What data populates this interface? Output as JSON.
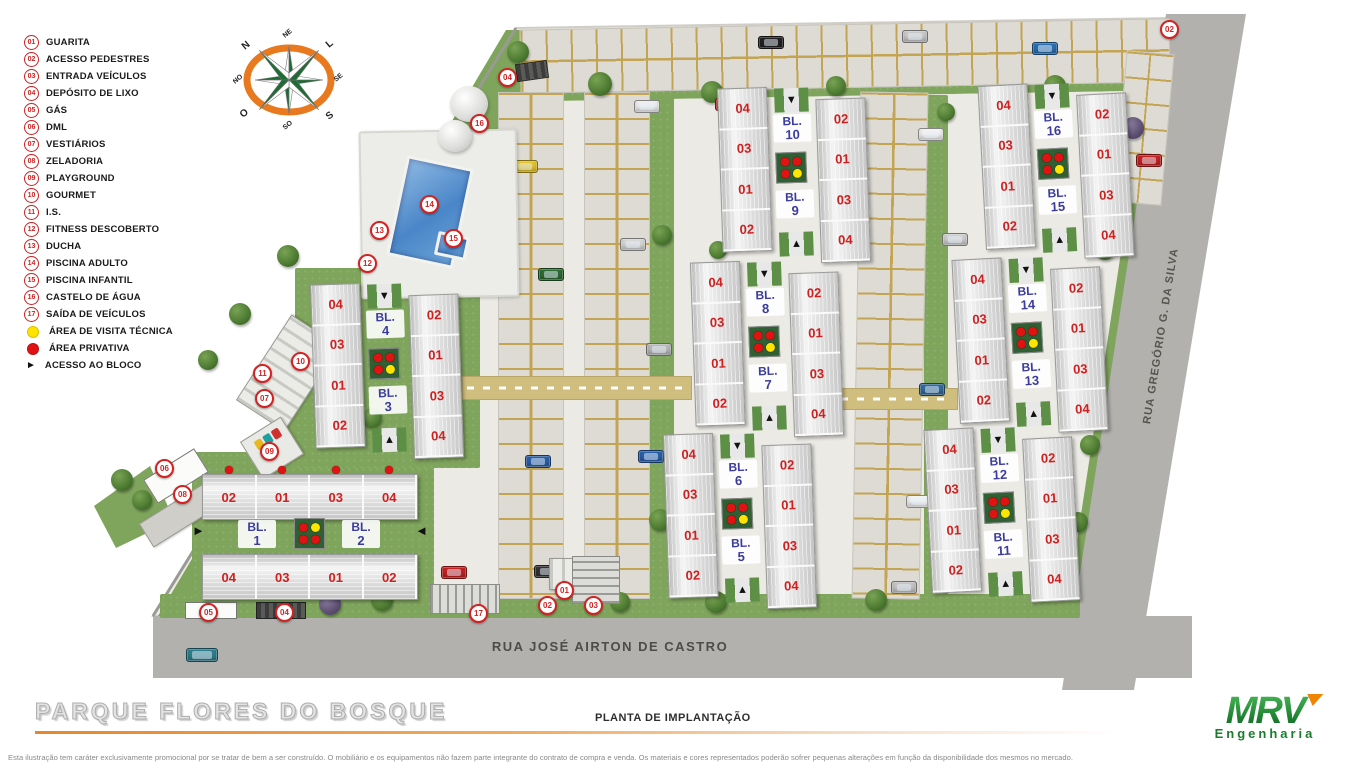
{
  "title": "PARQUE FLORES DO BOSQUE",
  "subtitle": "PLANTA DE IMPLANTAÇÃO",
  "brand": {
    "name": "MRV",
    "tagline": "Engenharia",
    "green": "#1c7c2e",
    "orange": "#f08300"
  },
  "disclaimer": "Esta ilustração tem caráter exclusivamente promocional por se tratar de bem a ser construído. O mobiliário e os equipamentos não fazem parte integrante do contrato de compra e venda. Os materiais e cores representados poderão sofrer pequenas alterações em função da disponibilidade dos mesmos no mercado.",
  "streets": {
    "bottom": "RUA JOSÉ AIRTON DE CASTRO",
    "right": "RUA GREGÓRIO G. DA SILVA"
  },
  "compass": {
    "points": [
      "N",
      "NE",
      "L",
      "SE",
      "S",
      "SO",
      "O",
      "NO"
    ]
  },
  "legend": {
    "items": [
      {
        "num": "01",
        "label": "GUARITA"
      },
      {
        "num": "02",
        "label": "ACESSO PEDESTRES"
      },
      {
        "num": "03",
        "label": "ENTRADA VEÍCULOS"
      },
      {
        "num": "04",
        "label": "DEPÓSITO DE LIXO"
      },
      {
        "num": "05",
        "label": "GÁS"
      },
      {
        "num": "06",
        "label": "DML"
      },
      {
        "num": "07",
        "label": "VESTIÁRIOS"
      },
      {
        "num": "08",
        "label": "ZELADORIA"
      },
      {
        "num": "09",
        "label": "PLAYGROUND"
      },
      {
        "num": "10",
        "label": "GOURMET"
      },
      {
        "num": "11",
        "label": "I.S."
      },
      {
        "num": "12",
        "label": "FITNESS DESCOBERTO"
      },
      {
        "num": "13",
        "label": "DUCHA"
      },
      {
        "num": "14",
        "label": "PISCINA ADULTO"
      },
      {
        "num": "15",
        "label": "PISCINA INFANTIL"
      },
      {
        "num": "16",
        "label": "CASTELO DE ÁGUA"
      },
      {
        "num": "17",
        "label": "SAÍDA DE VEÍCULOS"
      }
    ],
    "symbols": [
      {
        "type": "dot-yellow",
        "label": "ÁREA DE VISITA TÉCNICA",
        "color": "#ffe400"
      },
      {
        "type": "dot-red",
        "label": "ÁREA PRIVATIVA",
        "color": "#e01212"
      },
      {
        "type": "triangle",
        "label": "ACESSO AO BLOCO",
        "color": "#111111"
      }
    ]
  },
  "colors": {
    "dot_red": "#e01212",
    "dot_yellow": "#ffe400",
    "marker_red": "#d42222",
    "unit_number": "#cf2020",
    "bl_label": "#3c3c9e",
    "lawn": "#7fa45c",
    "road": "#b2b1ad",
    "pool": "#5b93cf"
  },
  "blocks": {
    "bl_prefix": "BL.",
    "vertical_unit_pattern": {
      "left": [
        "04",
        "03",
        "01",
        "02"
      ],
      "right": [
        "02",
        "01",
        "03",
        "04"
      ]
    },
    "vertical_dot_pattern": [
      "red",
      "red",
      "red",
      "yellow"
    ],
    "vertical_pairs": [
      {
        "bl_top": "4",
        "bl_bottom": "3",
        "x": 313,
        "y": 282,
        "rot": -2
      },
      {
        "bl_top": "10",
        "bl_bottom": "9",
        "x": 720,
        "y": 86,
        "rot": -2
      },
      {
        "bl_top": "8",
        "bl_bottom": "7",
        "x": 693,
        "y": 260,
        "rot": -2
      },
      {
        "bl_top": "6",
        "bl_bottom": "5",
        "x": 666,
        "y": 432,
        "rot": -2
      },
      {
        "bl_top": "16",
        "bl_bottom": "15",
        "x": 982,
        "y": 82,
        "rot": -3
      },
      {
        "bl_top": "14",
        "bl_bottom": "13",
        "x": 956,
        "y": 256,
        "rot": -3
      },
      {
        "bl_top": "12",
        "bl_bottom": "11",
        "x": 928,
        "y": 426,
        "rot": -3
      }
    ],
    "horizontal_pair": {
      "left_num": "1",
      "right_num": "2",
      "x": 200,
      "y": 466,
      "top_units": [
        "02",
        "01",
        "03",
        "04"
      ],
      "bottom_units": [
        "04",
        "03",
        "01",
        "02"
      ],
      "dot_pattern": [
        "red",
        "yellow",
        "red",
        "red"
      ]
    }
  },
  "markers": [
    {
      "num": "04",
      "x": 506,
      "y": 76
    },
    {
      "num": "16",
      "x": 478,
      "y": 122
    },
    {
      "num": "14",
      "x": 428,
      "y": 203
    },
    {
      "num": "13",
      "x": 378,
      "y": 229
    },
    {
      "num": "15",
      "x": 452,
      "y": 237
    },
    {
      "num": "12",
      "x": 366,
      "y": 262
    },
    {
      "num": "10",
      "x": 299,
      "y": 360
    },
    {
      "num": "11",
      "x": 261,
      "y": 372
    },
    {
      "num": "07",
      "x": 263,
      "y": 397
    },
    {
      "num": "09",
      "x": 268,
      "y": 450
    },
    {
      "num": "06",
      "x": 163,
      "y": 467
    },
    {
      "num": "08",
      "x": 181,
      "y": 493
    },
    {
      "num": "05",
      "x": 207,
      "y": 611
    },
    {
      "num": "04",
      "x": 283,
      "y": 611
    },
    {
      "num": "17",
      "x": 477,
      "y": 612
    },
    {
      "num": "01",
      "x": 563,
      "y": 589
    },
    {
      "num": "02",
      "x": 546,
      "y": 604
    },
    {
      "num": "03",
      "x": 592,
      "y": 604
    },
    {
      "num": "02",
      "x": 1168,
      "y": 28
    }
  ],
  "scenery": {
    "green": [
      {
        "x": 160,
        "y": 594,
        "w": 920,
        "h": 24
      },
      {
        "x": 650,
        "y": 95,
        "w": 24,
        "h": 500
      },
      {
        "x": 924,
        "y": 95,
        "w": 24,
        "h": 500
      },
      {
        "x": 520,
        "y": 86,
        "w": 642,
        "h": 10,
        "rot": -1
      },
      {
        "x": 192,
        "y": 452,
        "w": 242,
        "h": 146
      },
      {
        "x": 295,
        "y": 268,
        "w": 185,
        "h": 200
      }
    ],
    "lanes": [
      {
        "x": 520,
        "y": 24,
        "w": 648,
        "h": 62,
        "dir": "h",
        "rot": -1
      },
      {
        "x": 498,
        "y": 92,
        "w": 64,
        "h": 505,
        "dir": "v",
        "rot": 0
      },
      {
        "x": 584,
        "y": 92,
        "w": 64,
        "h": 505,
        "dir": "v",
        "rot": 0
      },
      {
        "x": 856,
        "y": 92,
        "w": 66,
        "h": 505,
        "dir": "v",
        "rot": 1
      },
      {
        "x": 1120,
        "y": 52,
        "w": 46,
        "h": 150,
        "dir": "v",
        "rot": 5
      }
    ],
    "paths": [
      {
        "x": 462,
        "y": 376,
        "w": 228,
        "h": 22
      },
      {
        "x": 836,
        "y": 388,
        "w": 120,
        "h": 20
      }
    ],
    "trees": [
      {
        "x": 518,
        "y": 52,
        "s": 22
      },
      {
        "x": 600,
        "y": 84,
        "s": 24
      },
      {
        "x": 712,
        "y": 92,
        "s": 22
      },
      {
        "x": 836,
        "y": 86,
        "s": 20
      },
      {
        "x": 1055,
        "y": 86,
        "s": 22
      },
      {
        "x": 492,
        "y": 158,
        "s": 20,
        "p": 1
      },
      {
        "x": 288,
        "y": 256,
        "s": 22
      },
      {
        "x": 240,
        "y": 314,
        "s": 22
      },
      {
        "x": 122,
        "y": 480,
        "s": 22
      },
      {
        "x": 142,
        "y": 500,
        "s": 20
      },
      {
        "x": 662,
        "y": 235,
        "s": 20
      },
      {
        "x": 660,
        "y": 520,
        "s": 22
      },
      {
        "x": 330,
        "y": 604,
        "s": 22,
        "p": 1
      },
      {
        "x": 382,
        "y": 600,
        "s": 22
      },
      {
        "x": 452,
        "y": 598,
        "s": 22
      },
      {
        "x": 620,
        "y": 602,
        "s": 20
      },
      {
        "x": 716,
        "y": 602,
        "s": 22
      },
      {
        "x": 876,
        "y": 600,
        "s": 22
      },
      {
        "x": 1133,
        "y": 128,
        "s": 22,
        "p": 1
      },
      {
        "x": 1105,
        "y": 250,
        "s": 20
      },
      {
        "x": 1090,
        "y": 445,
        "s": 20
      },
      {
        "x": 1078,
        "y": 522,
        "s": 20
      },
      {
        "x": 718,
        "y": 250,
        "s": 18
      },
      {
        "x": 946,
        "y": 112,
        "s": 18
      },
      {
        "x": 372,
        "y": 418,
        "s": 20
      },
      {
        "x": 208,
        "y": 360,
        "s": 20
      }
    ],
    "cars": [
      {
        "x": 758,
        "y": 36,
        "c": "#222222",
        "o": "h"
      },
      {
        "x": 1032,
        "y": 42,
        "c": "#2a6fb0",
        "o": "h"
      },
      {
        "x": 902,
        "y": 30,
        "c": "#c9c9c9",
        "o": "h"
      },
      {
        "x": 512,
        "y": 160,
        "c": "#e3c32e",
        "o": "h"
      },
      {
        "x": 538,
        "y": 268,
        "c": "#2e6b34",
        "o": "h"
      },
      {
        "x": 525,
        "y": 455,
        "c": "#2a5fa8",
        "o": "h"
      },
      {
        "x": 534,
        "y": 565,
        "c": "#333333",
        "o": "h"
      },
      {
        "x": 634,
        "y": 100,
        "c": "#eeeeee",
        "o": "h"
      },
      {
        "x": 620,
        "y": 238,
        "c": "#d6d6d6",
        "o": "h"
      },
      {
        "x": 646,
        "y": 343,
        "c": "#b9b9b9",
        "o": "h"
      },
      {
        "x": 638,
        "y": 450,
        "c": "#2a5fa8",
        "o": "h"
      },
      {
        "x": 918,
        "y": 128,
        "c": "#f2f2f2",
        "o": "h"
      },
      {
        "x": 942,
        "y": 233,
        "c": "#cfcfcf",
        "o": "h"
      },
      {
        "x": 919,
        "y": 383,
        "c": "#336b99",
        "o": "h"
      },
      {
        "x": 906,
        "y": 495,
        "c": "#f2f2f2",
        "o": "h"
      },
      {
        "x": 891,
        "y": 581,
        "c": "#c4c4c4",
        "o": "h"
      },
      {
        "x": 1136,
        "y": 154,
        "c": "#c32222",
        "o": "h"
      },
      {
        "x": 441,
        "y": 566,
        "c": "#c32222",
        "o": "h"
      },
      {
        "x": 715,
        "y": 98,
        "c": "#c32222",
        "o": "h"
      },
      {
        "x": 186,
        "y": 648,
        "c": "#2e7d8c",
        "o": "bus"
      }
    ]
  }
}
